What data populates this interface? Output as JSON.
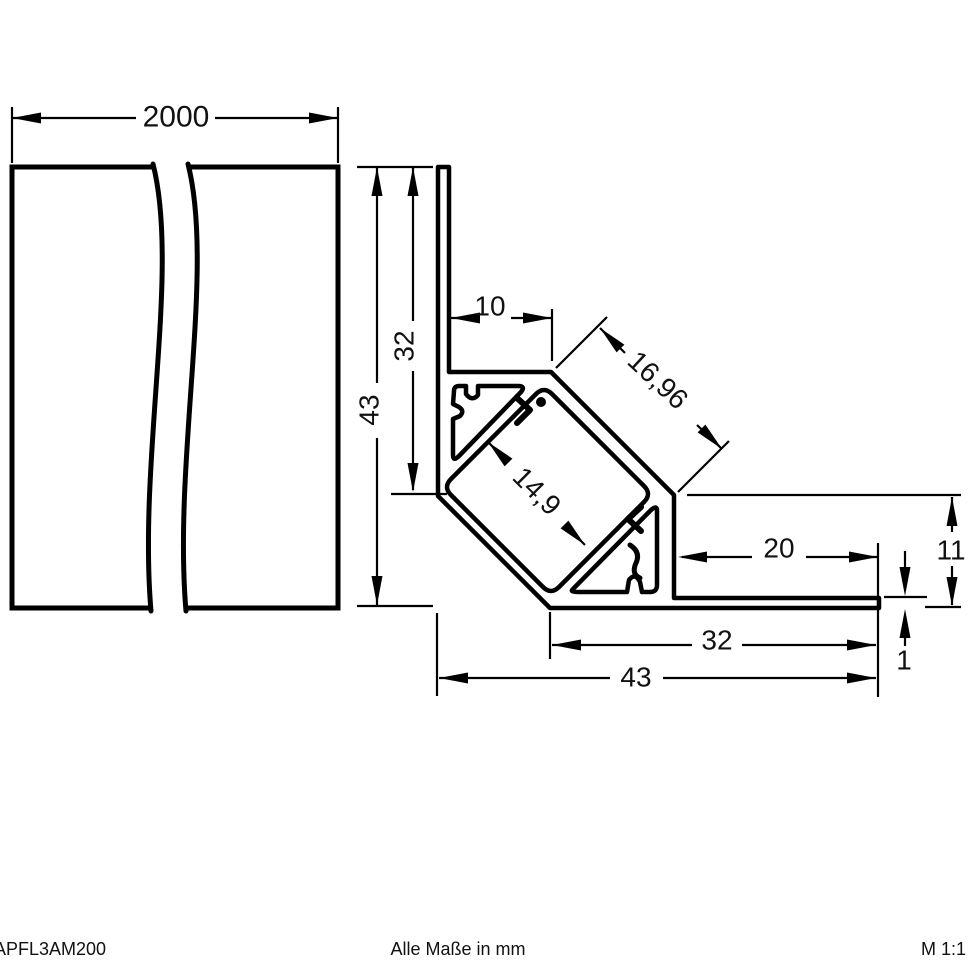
{
  "footer": {
    "article_number": "APFL3AM200",
    "units_note": "Alle Maße in mm",
    "scale": "M 1:1"
  },
  "dimensions": {
    "profile_length": "2000",
    "height_total": "43",
    "height_to_base": "32",
    "top_ledge": "10",
    "cover_face": "16,96",
    "channel_inner": "14,9",
    "flange_free_length": "20",
    "corner_height": "11",
    "flange_thickness": "1",
    "base_width_inner": "32",
    "base_width_total": "43"
  }
}
